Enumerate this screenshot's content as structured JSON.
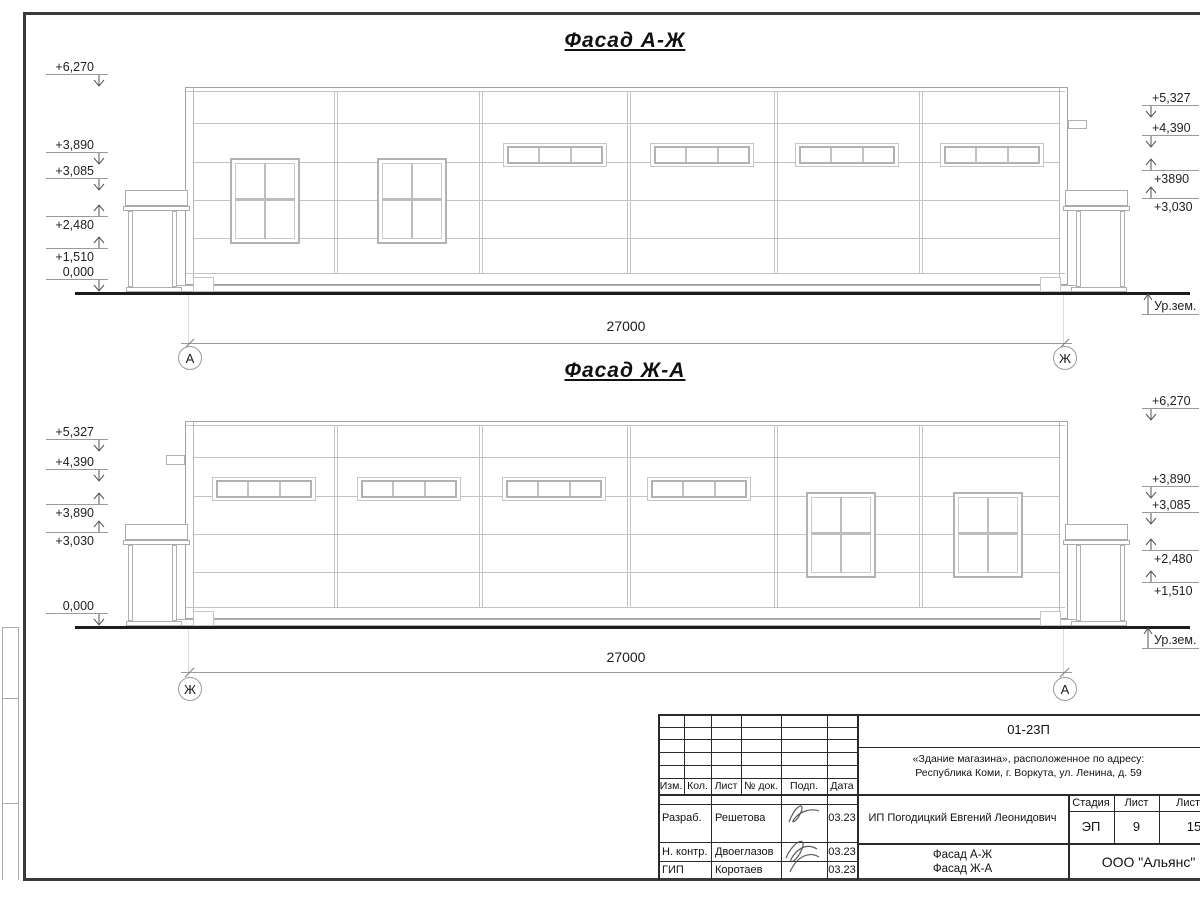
{
  "facades": [
    {
      "title": "Фасад А-Ж",
      "dimension": "27000",
      "axis_left": "А",
      "axis_right": "Ж",
      "marks": [
        {
          "label": "+6,270",
          "side": "L",
          "dir": "down"
        },
        {
          "label": "+3,890",
          "side": "L",
          "dir": "down"
        },
        {
          "label": "+3,085",
          "side": "L",
          "dir": "down"
        },
        {
          "label": "+2,480",
          "side": "L",
          "dir": "up"
        },
        {
          "label": "+1,510",
          "side": "L",
          "dir": "up"
        },
        {
          "label": "0,000",
          "side": "L",
          "dir": "down"
        },
        {
          "label": "+5,327",
          "side": "R",
          "dir": "down"
        },
        {
          "label": "+4,390",
          "side": "R",
          "dir": "down"
        },
        {
          "label": "+3890",
          "side": "R",
          "dir": "up"
        },
        {
          "label": "+3,030",
          "side": "R",
          "dir": "up"
        },
        {
          "label": "Ур.зем.",
          "side": "R",
          "dir": "ground"
        }
      ]
    },
    {
      "title": "Фасад Ж-А",
      "dimension": "27000",
      "axis_left": "Ж",
      "axis_right": "А",
      "marks": [
        {
          "label": "+5,327",
          "side": "L",
          "dir": "down"
        },
        {
          "label": "+4,390",
          "side": "L",
          "dir": "down"
        },
        {
          "label": "+3,890",
          "side": "L",
          "dir": "up"
        },
        {
          "label": "+3,030",
          "side": "L",
          "dir": "up"
        },
        {
          "label": "0,000",
          "side": "L",
          "dir": "down"
        },
        {
          "label": "+6,270",
          "side": "R",
          "dir": "down"
        },
        {
          "label": "+3,890",
          "side": "R",
          "dir": "down"
        },
        {
          "label": "+3,085",
          "side": "R",
          "dir": "down"
        },
        {
          "label": "+2,480",
          "side": "R",
          "dir": "up"
        },
        {
          "label": "+1,510",
          "side": "R",
          "dir": "up"
        },
        {
          "label": "Ур.зем.",
          "side": "R",
          "dir": "ground"
        }
      ]
    }
  ],
  "title_block": {
    "doc_number": "01-23П",
    "project_line1": "«Здание магазина», расположенное по адресу:",
    "project_line2": "Республика Коми, г. Воркута, ул. Ленина, д. 59",
    "client": "ИП Погодицкий Евгений Леонидович",
    "header_cols": [
      "Изм.",
      "Кол.",
      "Лист",
      "№ док.",
      "Подп.",
      "Дата"
    ],
    "rows": [
      {
        "role": "Разраб.",
        "name": "Решетова",
        "date": "03.23"
      },
      {
        "role": "Н. контр.",
        "name": "Двоеглазов",
        "date": "03.23"
      },
      {
        "role": "ГИП",
        "name": "Коротаев",
        "date": "03.23"
      }
    ],
    "stage_label": "Стадия",
    "sheet_label": "Лист",
    "sheets_label": "Листов",
    "stage": "ЭП",
    "sheet": "9",
    "sheets": "15",
    "drawing_title_line1": "Фасад А-Ж",
    "drawing_title_line2": "Фасад Ж-А",
    "company": "ООО \"Альянс\""
  }
}
